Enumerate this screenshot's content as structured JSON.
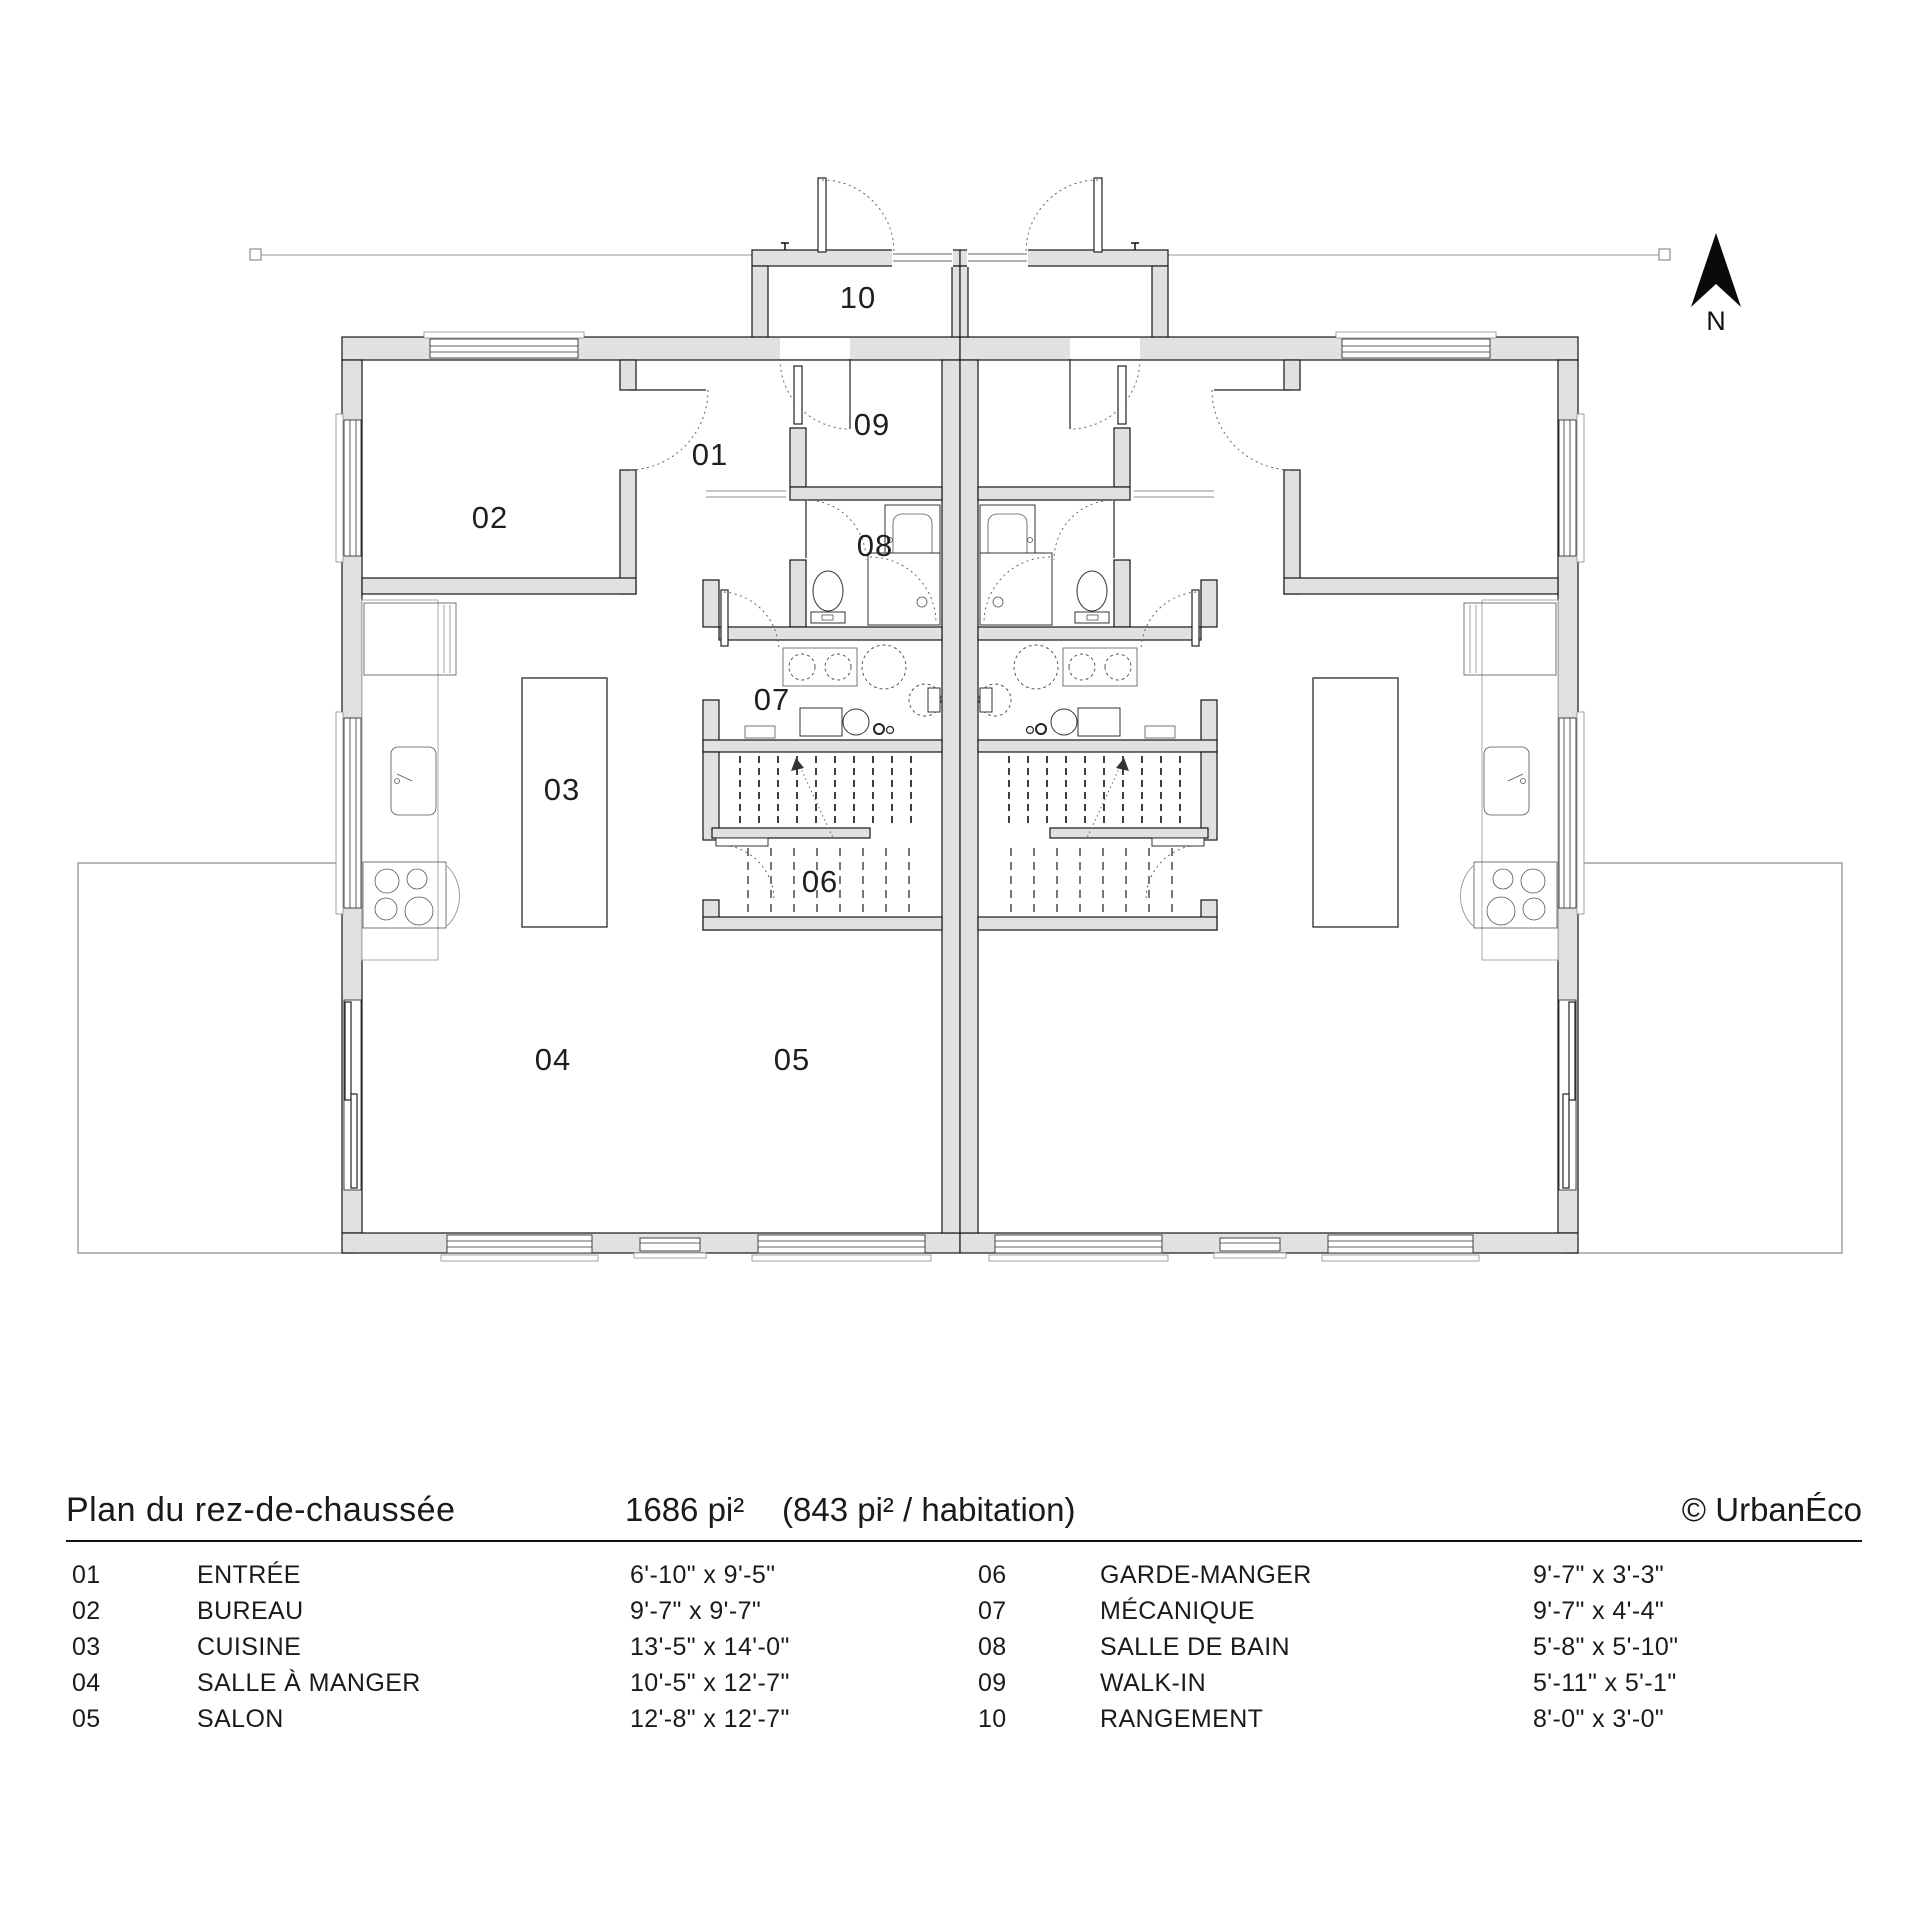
{
  "plan": {
    "north_label": "N",
    "room_labels": [
      "10",
      "02",
      "01",
      "09",
      "08",
      "07",
      "03",
      "06",
      "04",
      "05"
    ]
  },
  "title_block": {
    "title": "Plan du rez-de-chaussée",
    "area_total": "1686 pi²",
    "area_per_unit": "(843 pi² / habitation)",
    "credit": "© UrbanÉco"
  },
  "legend": {
    "left": [
      {
        "num": "01",
        "name": "ENTRÉE",
        "dims": "6'-10\" x 9'-5\""
      },
      {
        "num": "02",
        "name": "BUREAU",
        "dims": "9'-7\" x 9'-7\""
      },
      {
        "num": "03",
        "name": "CUISINE",
        "dims": "13'-5\" x 14'-0\""
      },
      {
        "num": "04",
        "name": "SALLE À MANGER",
        "dims": "10'-5\" x 12'-7\""
      },
      {
        "num": "05",
        "name": "SALON",
        "dims": "12'-8\" x 12'-7\""
      }
    ],
    "right": [
      {
        "num": "06",
        "name": "GARDE-MANGER",
        "dims": "9'-7\" x 3'-3\""
      },
      {
        "num": "07",
        "name": "MÉCANIQUE",
        "dims": "9'-7\" x 4'-4\""
      },
      {
        "num": "08",
        "name": "SALLE DE BAIN",
        "dims": "5'-8\" x 5'-10\""
      },
      {
        "num": "09",
        "name": "WALK-IN",
        "dims": "5'-11\" x 5'-1\""
      },
      {
        "num": "10",
        "name": "RANGEMENT",
        "dims": "8'-0\" x 3'-0\""
      }
    ]
  }
}
